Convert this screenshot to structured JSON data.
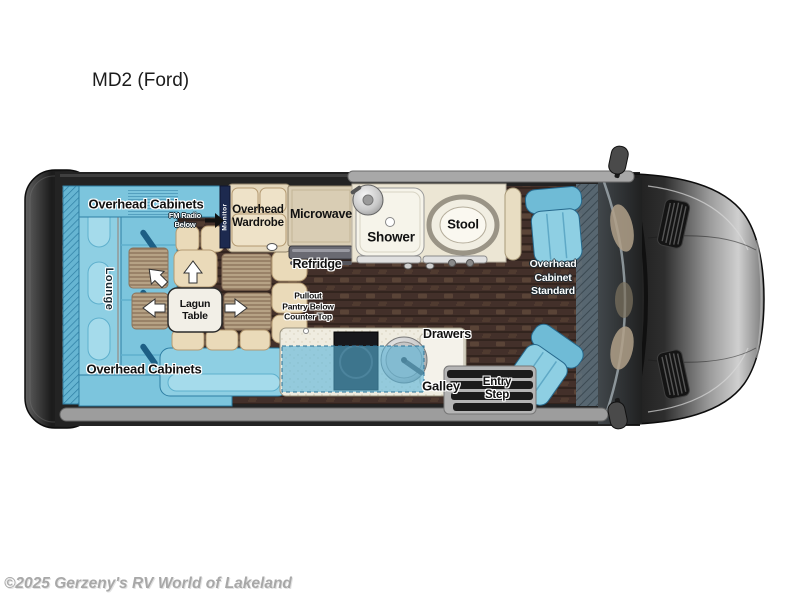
{
  "page": {
    "title": "MD2 (Ford)",
    "watermark": "©2025 Gerzeny's RV World of Lakeland"
  },
  "floorplan": {
    "labels": {
      "overhead_cabinets_top": "Overhead Cabinets",
      "fm_radio": [
        "FM Radio",
        "Below"
      ],
      "monitor": "Monitor",
      "overhead_wardrobe": [
        "Overhead",
        "Wardrobe"
      ],
      "microwave": "Microwave",
      "refridge": "Refridge",
      "shower": "Shower",
      "stool": "Stool",
      "overhead_cabinet_standard": [
        "Overhead",
        "Cabinet",
        "Standard"
      ],
      "lounge": "Lounge",
      "lagun_table": [
        "Lagun",
        "Table"
      ],
      "overhead_cabinets_bottom": "Overhead Cabinets",
      "pullout_pantry": [
        "Pullout",
        "Pantry Below",
        "Counter Top"
      ],
      "drawers": "Drawers",
      "galley": "Galley",
      "entry_step": [
        "Entry",
        "Step"
      ]
    },
    "colors": {
      "seating_blue": "#8ECFE3",
      "cabinet_blue": "#7CC5DD",
      "cushion_beige": "#EADAB9",
      "floor_brown": "#43302A",
      "body_dark": "#232323",
      "counter": "#EFECE0",
      "label_ink": "#111111"
    }
  }
}
